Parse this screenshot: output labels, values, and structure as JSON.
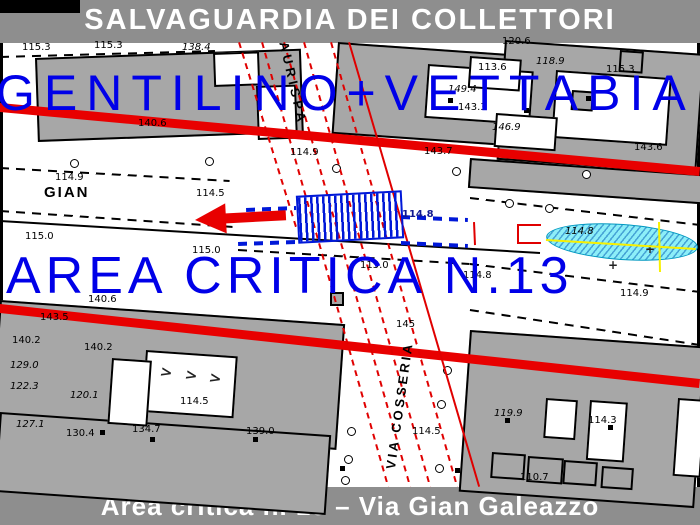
{
  "header": {
    "title": "SALVAGUARDIA DEI COLLETTORI"
  },
  "footer": {
    "caption": "Area critica n. 13 – Via Gian Galeazzo"
  },
  "overlay": {
    "collectors_label": "GENTILINO+VETTABIA",
    "critical_area_label": "AREA CRITICA N.13",
    "color": "#0000e8"
  },
  "colors": {
    "band_gray": "#8e8e8e",
    "building_gray": "#a7a7a7",
    "red": "#e80000",
    "blue": "#0018d8",
    "cyan_fill": "#8ceef8",
    "yellow": "#f8f000"
  },
  "map": {
    "street_labels": [
      {
        "t": "GIAN",
        "x": 44,
        "y": 184,
        "rot": 0,
        "size": 15,
        "ls": 2
      },
      {
        "t": "AURISPA",
        "x": 291,
        "y": 40,
        "rot": 77,
        "size": 13,
        "ls": 4
      },
      {
        "t": "VIA COSSERIA",
        "x": 383,
        "y": 468,
        "rot": -82,
        "size": 13,
        "ls": 3
      }
    ],
    "elevations": [
      {
        "t": "115.3",
        "x": 22,
        "y": 42
      },
      {
        "t": "115.3",
        "x": 94,
        "y": 40
      },
      {
        "t": "138.4",
        "x": 182,
        "y": 42,
        "i": 1
      },
      {
        "t": "140.6",
        "x": 138,
        "y": 118
      },
      {
        "t": "149.4",
        "x": 448,
        "y": 84,
        "i": 1
      },
      {
        "t": "143.7",
        "x": 424,
        "y": 146
      },
      {
        "t": "120.6",
        "x": 502,
        "y": 36
      },
      {
        "t": "113.6",
        "x": 478,
        "y": 62
      },
      {
        "t": "118.9",
        "x": 536,
        "y": 56,
        "i": 1
      },
      {
        "t": "115.3",
        "x": 606,
        "y": 64
      },
      {
        "t": "143.3",
        "x": 458,
        "y": 102
      },
      {
        "t": "146.9",
        "x": 492,
        "y": 122,
        "i": 1
      },
      {
        "t": "143.6",
        "x": 634,
        "y": 142
      },
      {
        "t": "114.9",
        "x": 290,
        "y": 147
      },
      {
        "t": "114.9",
        "x": 55,
        "y": 172
      },
      {
        "t": "114.5",
        "x": 196,
        "y": 188
      },
      {
        "t": "115.0",
        "x": 25,
        "y": 231
      },
      {
        "t": "115.0",
        "x": 192,
        "y": 245
      },
      {
        "t": "114.8",
        "x": 402,
        "y": 209,
        "c": "#101890"
      },
      {
        "t": "114.8",
        "x": 565,
        "y": 226,
        "i": 1
      },
      {
        "t": "115.0",
        "x": 360,
        "y": 260
      },
      {
        "t": "114.9",
        "x": 620,
        "y": 288
      },
      {
        "t": "114.8",
        "x": 463,
        "y": 270
      },
      {
        "t": "145",
        "x": 396,
        "y": 319
      },
      {
        "t": "140.6",
        "x": 88,
        "y": 294
      },
      {
        "t": "143.5",
        "x": 40,
        "y": 312
      },
      {
        "t": "140.2",
        "x": 12,
        "y": 335
      },
      {
        "t": "140.2",
        "x": 84,
        "y": 342
      },
      {
        "t": "129.0",
        "x": 10,
        "y": 360,
        "i": 1
      },
      {
        "t": "122.3",
        "x": 10,
        "y": 381,
        "i": 1
      },
      {
        "t": "120.1",
        "x": 70,
        "y": 390,
        "i": 1
      },
      {
        "t": "114.5",
        "x": 180,
        "y": 396
      },
      {
        "t": "127.1",
        "x": 16,
        "y": 419,
        "i": 1
      },
      {
        "t": "130.4",
        "x": 66,
        "y": 428
      },
      {
        "t": "134.7",
        "x": 132,
        "y": 424
      },
      {
        "t": "139.0",
        "x": 246,
        "y": 426
      },
      {
        "t": "114.5",
        "x": 412,
        "y": 426
      },
      {
        "t": "119.9",
        "x": 494,
        "y": 408,
        "i": 1
      },
      {
        "t": "114.3",
        "x": 588,
        "y": 415
      },
      {
        "t": "110.7",
        "x": 520,
        "y": 472
      }
    ],
    "buildings": [
      [
        35,
        58,
        262,
        80,
        -2,
        "g"
      ],
      [
        338,
        42,
        178,
        88,
        4,
        "g"
      ],
      [
        505,
        40,
        196,
        116,
        4,
        "g"
      ],
      [
        470,
        158,
        232,
        26,
        4,
        "g"
      ],
      [
        0,
        300,
        342,
        122,
        4,
        "g"
      ],
      [
        0,
        412,
        328,
        76,
        4,
        "g"
      ],
      [
        470,
        330,
        232,
        158,
        4,
        "g"
      ],
      [
        213,
        53,
        42,
        30,
        -2,
        "w"
      ],
      [
        256,
        86,
        36,
        50,
        -2,
        "w"
      ],
      [
        428,
        64,
        102,
        50,
        4,
        "w"
      ],
      [
        470,
        56,
        48,
        28,
        4,
        "w"
      ],
      [
        556,
        70,
        112,
        64,
        4,
        "w"
      ],
      [
        496,
        113,
        58,
        30,
        4,
        "w"
      ],
      [
        146,
        350,
        88,
        58,
        4,
        "w"
      ],
      [
        112,
        358,
        36,
        62,
        4,
        "w"
      ],
      [
        546,
        398,
        28,
        36,
        4,
        "w"
      ],
      [
        590,
        400,
        34,
        56,
        4,
        "w"
      ],
      [
        678,
        398,
        24,
        74,
        4,
        "w"
      ],
      [
        572,
        90,
        18,
        16,
        4,
        "d"
      ],
      [
        620,
        50,
        20,
        18,
        4,
        "d"
      ],
      [
        492,
        452,
        30,
        22,
        4,
        "d"
      ],
      [
        528,
        456,
        32,
        22,
        4,
        "d"
      ],
      [
        564,
        460,
        30,
        20,
        4,
        "d"
      ],
      [
        602,
        466,
        28,
        18,
        4,
        "d"
      ],
      [
        330,
        292,
        10,
        10,
        0,
        "d"
      ]
    ],
    "dots": [
      [
        448,
        98
      ],
      [
        524,
        108
      ],
      [
        586,
        96
      ],
      [
        100,
        430
      ],
      [
        150,
        437
      ],
      [
        253,
        437
      ],
      [
        505,
        418
      ],
      [
        608,
        425
      ],
      [
        455,
        468
      ],
      [
        340,
        466
      ]
    ],
    "black_solid": [
      [
        0,
        220,
        540,
        252
      ]
    ],
    "black_dashed": [
      [
        0,
        56,
        215,
        50
      ],
      [
        0,
        167,
        230,
        180
      ],
      [
        0,
        210,
        233,
        226
      ],
      [
        238,
        249,
        470,
        263
      ],
      [
        470,
        263,
        700,
        291
      ],
      [
        470,
        197,
        700,
        224
      ],
      [
        470,
        309,
        700,
        344
      ]
    ],
    "red_thick": [
      [
        0,
        103,
        700,
        167
      ],
      [
        0,
        304,
        700,
        379
      ]
    ],
    "red_dashed": [
      [
        240,
        42,
        298,
        230
      ],
      [
        263,
        42,
        389,
        486
      ],
      [
        285,
        42,
        411,
        486
      ],
      [
        305,
        42,
        431,
        486
      ],
      [
        332,
        42,
        458,
        486
      ]
    ],
    "red_solid": [
      [
        350,
        42,
        480,
        486
      ],
      [
        475,
        222,
        476,
        245
      ]
    ],
    "blue_dashed": [
      [
        246,
        208,
        296,
        206
      ],
      [
        238,
        242,
        296,
        240
      ],
      [
        401,
        215,
        468,
        218
      ],
      [
        401,
        241,
        468,
        244
      ]
    ],
    "yellow_lines": [
      [
        546,
        239,
        696,
        248
      ],
      [
        660,
        222,
        661,
        272
      ]
    ],
    "trees": [
      [
        70,
        159
      ],
      [
        205,
        157
      ],
      [
        332,
        164
      ],
      [
        452,
        167
      ],
      [
        582,
        170
      ],
      [
        505,
        199
      ],
      [
        545,
        204
      ],
      [
        443,
        366
      ],
      [
        347,
        427
      ],
      [
        344,
        455
      ],
      [
        341,
        476
      ],
      [
        437,
        400
      ],
      [
        435,
        464
      ]
    ],
    "marks": [
      {
        "t": ">",
        "x": 162,
        "y": 362,
        "rot": 12,
        "size": 15
      },
      {
        "t": ">",
        "x": 187,
        "y": 365,
        "rot": 12,
        "size": 15
      },
      {
        "t": ">",
        "x": 211,
        "y": 368,
        "rot": 12,
        "size": 15
      },
      {
        "t": "+",
        "x": 608,
        "y": 258,
        "rot": 0,
        "size": 12
      },
      {
        "t": "+",
        "x": 645,
        "y": 242,
        "rot": 0,
        "size": 12
      }
    ]
  }
}
